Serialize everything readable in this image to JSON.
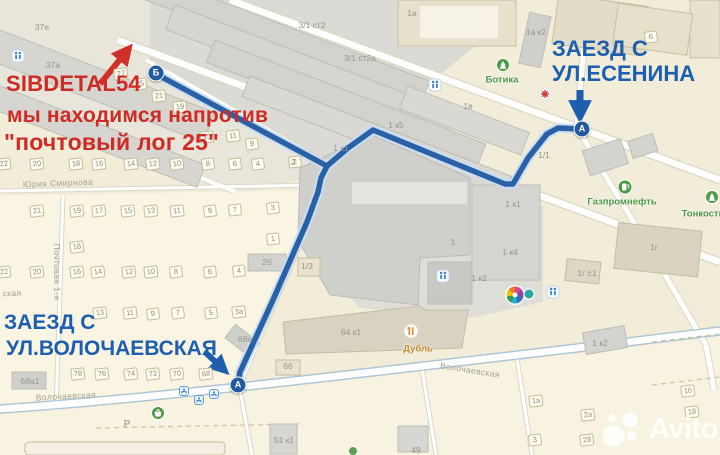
{
  "annotations": {
    "brand": "SIBDETAL54",
    "line1": "мы находимся напротив",
    "line2": "\"почтовый лог 25\"",
    "entrance_top": {
      "line1": "ЗАЕЗД С",
      "line2": "УЛ.ЕСЕНИНА"
    },
    "entrance_bottom": {
      "line1": "ЗАЕЗД С",
      "line2": "УЛ.ВОЛОЧАЕВСКАЯ"
    },
    "colors": {
      "red": "#ce2b24",
      "navy": "#1d5fae"
    }
  },
  "watermark": {
    "text": "Avito"
  },
  "map": {
    "route_color": "#2a61a6",
    "markers": [
      {
        "label": "Б",
        "x": 156,
        "y": 73
      },
      {
        "label": "А",
        "x": 582,
        "y": 129
      },
      {
        "label": "А",
        "x": 238,
        "y": 385
      }
    ],
    "plots": [
      {
        "label": "22",
        "x": 4,
        "y": 164
      },
      {
        "label": "20",
        "x": 37,
        "y": 164
      },
      {
        "label": "18",
        "x": 76,
        "y": 164
      },
      {
        "label": "16",
        "x": 99,
        "y": 164
      },
      {
        "label": "14",
        "x": 131,
        "y": 164
      },
      {
        "label": "12",
        "x": 153,
        "y": 164
      },
      {
        "label": "10",
        "x": 177,
        "y": 164
      },
      {
        "label": "8",
        "x": 208,
        "y": 164
      },
      {
        "label": "6",
        "x": 235,
        "y": 164
      },
      {
        "label": "4",
        "x": 258,
        "y": 164
      },
      {
        "label": "2",
        "x": 295,
        "y": 162
      },
      {
        "label": "27",
        "x": 121,
        "y": 74
      },
      {
        "label": "25",
        "x": 140,
        "y": 84
      },
      {
        "label": "21",
        "x": 159,
        "y": 96
      },
      {
        "label": "19",
        "x": 180,
        "y": 107
      },
      {
        "label": "15",
        "x": 207,
        "y": 137
      },
      {
        "label": "11",
        "x": 233,
        "y": 136
      },
      {
        "label": "9",
        "x": 252,
        "y": 144
      },
      {
        "label": "21",
        "x": 37,
        "y": 211
      },
      {
        "label": "19",
        "x": 77,
        "y": 211
      },
      {
        "label": "17",
        "x": 99,
        "y": 211
      },
      {
        "label": "15",
        "x": 128,
        "y": 211
      },
      {
        "label": "13",
        "x": 151,
        "y": 211
      },
      {
        "label": "11",
        "x": 177,
        "y": 211
      },
      {
        "label": "9",
        "x": 210,
        "y": 211
      },
      {
        "label": "7",
        "x": 235,
        "y": 210
      },
      {
        "label": "3",
        "x": 273,
        "y": 208
      },
      {
        "label": "1",
        "x": 273,
        "y": 239
      },
      {
        "label": "18",
        "x": 77,
        "y": 247
      },
      {
        "label": "22",
        "x": 4,
        "y": 272
      },
      {
        "label": "20",
        "x": 37,
        "y": 272
      },
      {
        "label": "16",
        "x": 77,
        "y": 272
      },
      {
        "label": "14",
        "x": 98,
        "y": 272
      },
      {
        "label": "12",
        "x": 129,
        "y": 272
      },
      {
        "label": "10",
        "x": 151,
        "y": 272
      },
      {
        "label": "8",
        "x": 176,
        "y": 272
      },
      {
        "label": "6",
        "x": 210,
        "y": 272
      },
      {
        "label": "4",
        "x": 239,
        "y": 271
      },
      {
        "label": "13",
        "x": 100,
        "y": 313
      },
      {
        "label": "11",
        "x": 130,
        "y": 313
      },
      {
        "label": "9",
        "x": 153,
        "y": 314
      },
      {
        "label": "7",
        "x": 178,
        "y": 313
      },
      {
        "label": "5",
        "x": 211,
        "y": 313
      },
      {
        "label": "3а",
        "x": 239,
        "y": 312
      },
      {
        "label": "78",
        "x": 78,
        "y": 374
      },
      {
        "label": "76",
        "x": 102,
        "y": 374
      },
      {
        "label": "74",
        "x": 131,
        "y": 374
      },
      {
        "label": "72",
        "x": 153,
        "y": 374
      },
      {
        "label": "70",
        "x": 177,
        "y": 374
      },
      {
        "label": "68",
        "x": 206,
        "y": 374
      },
      {
        "label": "6",
        "x": 651,
        "y": 37
      },
      {
        "label": "1а",
        "x": 536,
        "y": 401
      },
      {
        "label": "2а",
        "x": 588,
        "y": 415
      },
      {
        "label": "3",
        "x": 535,
        "y": 440
      },
      {
        "label": "28",
        "x": 587,
        "y": 440
      },
      {
        "label": "16",
        "x": 688,
        "y": 391
      },
      {
        "label": "18",
        "x": 692,
        "y": 412
      }
    ],
    "building_labels": [
      {
        "label": "37е",
        "x": 42,
        "y": 27
      },
      {
        "label": "37а",
        "x": 53,
        "y": 65
      },
      {
        "label": "3/1 ст2",
        "x": 312,
        "y": 25
      },
      {
        "label": "3/1 ст2а",
        "x": 360,
        "y": 58
      },
      {
        "label": "1а",
        "x": 412,
        "y": 13
      },
      {
        "label": "1а к2",
        "x": 536,
        "y": 32
      },
      {
        "label": "1в",
        "x": 468,
        "y": 106
      },
      {
        "label": "1 к5",
        "x": 396,
        "y": 125
      },
      {
        "label": "1 к1",
        "x": 341,
        "y": 148
      },
      {
        "label": "2",
        "x": 293,
        "y": 162
      },
      {
        "label": "1/1",
        "x": 544,
        "y": 155
      },
      {
        "label": "1",
        "x": 453,
        "y": 242
      },
      {
        "label": "1 к4",
        "x": 510,
        "y": 252
      },
      {
        "label": "1 к2",
        "x": 479,
        "y": 278
      },
      {
        "label": "1 к1",
        "x": 513,
        "y": 204
      },
      {
        "label": "1г",
        "x": 654,
        "y": 247
      },
      {
        "label": "1г с1",
        "x": 587,
        "y": 273
      },
      {
        "label": "1 к2",
        "x": 600,
        "y": 343
      },
      {
        "label": "2б",
        "x": 267,
        "y": 262
      },
      {
        "label": "1/3",
        "x": 307,
        "y": 266
      },
      {
        "label": "64 к1",
        "x": 351,
        "y": 332
      },
      {
        "label": "66",
        "x": 288,
        "y": 366
      },
      {
        "label": "68а",
        "x": 245,
        "y": 339
      },
      {
        "label": "68а1",
        "x": 30,
        "y": 381
      },
      {
        "label": "51 к1",
        "x": 284,
        "y": 440
      },
      {
        "label": "49",
        "x": 416,
        "y": 450
      }
    ],
    "street_labels": [
      {
        "label": "Юрия Смирнова",
        "x": 58,
        "y": 183,
        "rot": -2
      },
      {
        "label": "Почтовая 1-я",
        "x": 57,
        "y": 272,
        "rot": 90
      },
      {
        "label": "Волочаевская",
        "x": 66,
        "y": 396,
        "rot": -3
      },
      {
        "label": "Волочаевская",
        "x": 470,
        "y": 370,
        "rot": 9
      },
      {
        "label": "ская",
        "x": 12,
        "y": 293,
        "rot": -2
      }
    ],
    "poi_labels": [
      {
        "label": "Ботика",
        "x": 502,
        "y": 80,
        "color": "green"
      },
      {
        "label": "Газпромнефть",
        "x": 622,
        "y": 202,
        "color": "green"
      },
      {
        "label": "Тонкости",
        "x": 703,
        "y": 214,
        "color": "green"
      },
      {
        "label": "Дубль",
        "x": 418,
        "y": 349,
        "color": "orange"
      }
    ],
    "poi_colors": {
      "green": "#4e9644",
      "orange": "#c6872d"
    },
    "icons": [
      {
        "type": "crosswalk-icon",
        "x": 18,
        "y": 56
      },
      {
        "type": "crosswalk-icon",
        "x": 435,
        "y": 85
      },
      {
        "type": "crosswalk-icon",
        "x": 443,
        "y": 276
      },
      {
        "type": "crosswalk-icon",
        "x": 553,
        "y": 292
      },
      {
        "type": "transit-stop-icon",
        "x": 184,
        "y": 391
      },
      {
        "type": "transit-stop-icon",
        "x": 199,
        "y": 400
      },
      {
        "type": "transit-stop-icon",
        "x": 214,
        "y": 394
      },
      {
        "type": "fuel-icon",
        "x": 625,
        "y": 187
      },
      {
        "type": "tree-icon",
        "x": 503,
        "y": 65
      },
      {
        "type": "tree-icon",
        "x": 712,
        "y": 197
      },
      {
        "type": "restaurant-icon",
        "x": 411,
        "y": 331
      },
      {
        "type": "red-burst-icon",
        "x": 545,
        "y": 94
      },
      {
        "type": "basket-icon",
        "x": 158,
        "y": 413
      },
      {
        "type": "mall-icon",
        "x": 515,
        "y": 295
      },
      {
        "type": "teal-dot-icon",
        "x": 529,
        "y": 294
      },
      {
        "type": "green-dot-icon",
        "x": 353,
        "y": 451
      },
      {
        "type": "parking-icon",
        "x": 127,
        "y": 425,
        "label": "Р"
      }
    ]
  }
}
